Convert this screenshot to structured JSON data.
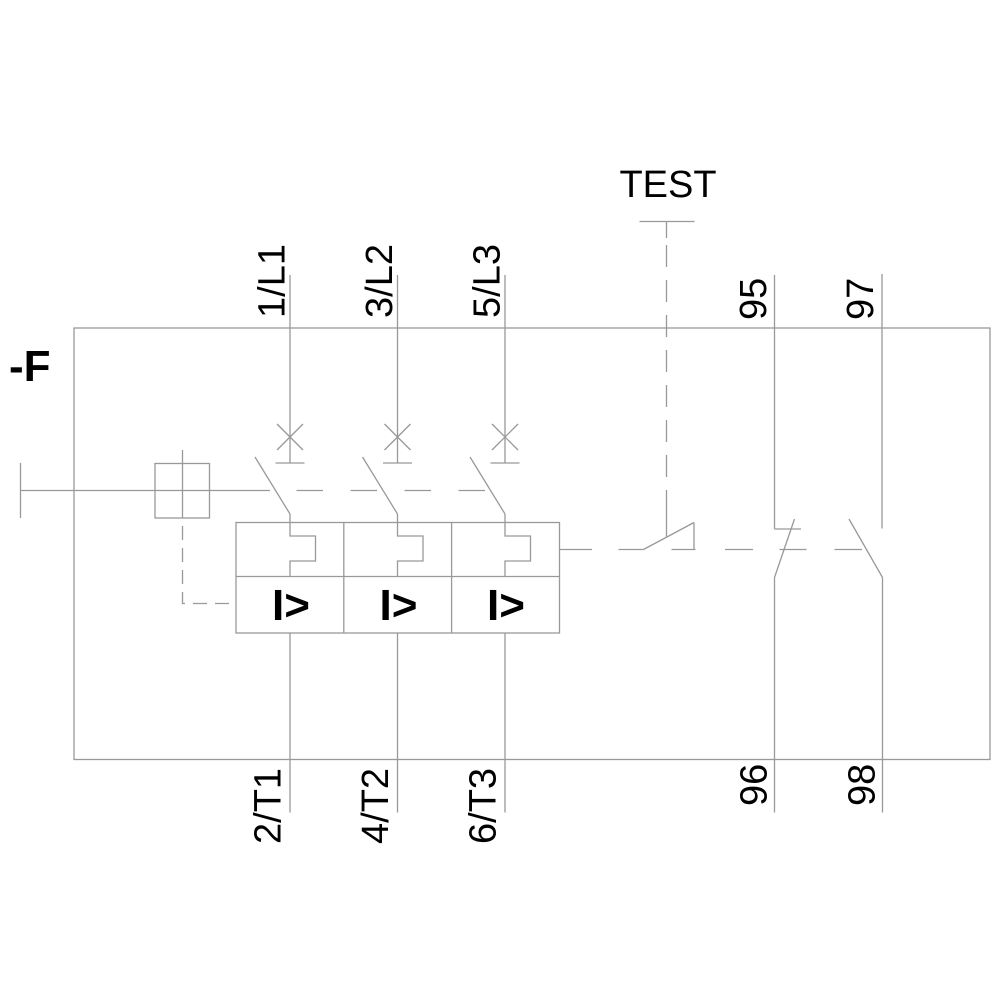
{
  "diagram": {
    "device_label": "-F",
    "test_button_label": "TEST",
    "top_terminals": [
      "1/L1",
      "3/L2",
      "5/L3"
    ],
    "bottom_terminals": [
      "2/T1",
      "4/T2",
      "6/T3"
    ],
    "aux_top_terminals": [
      "95",
      "97"
    ],
    "aux_bottom_terminals": [
      "96",
      "98"
    ],
    "overcurrent_trip_symbol": "I>",
    "colors": {
      "line": "#999999",
      "text": "#000000",
      "background": "#ffffff"
    }
  }
}
